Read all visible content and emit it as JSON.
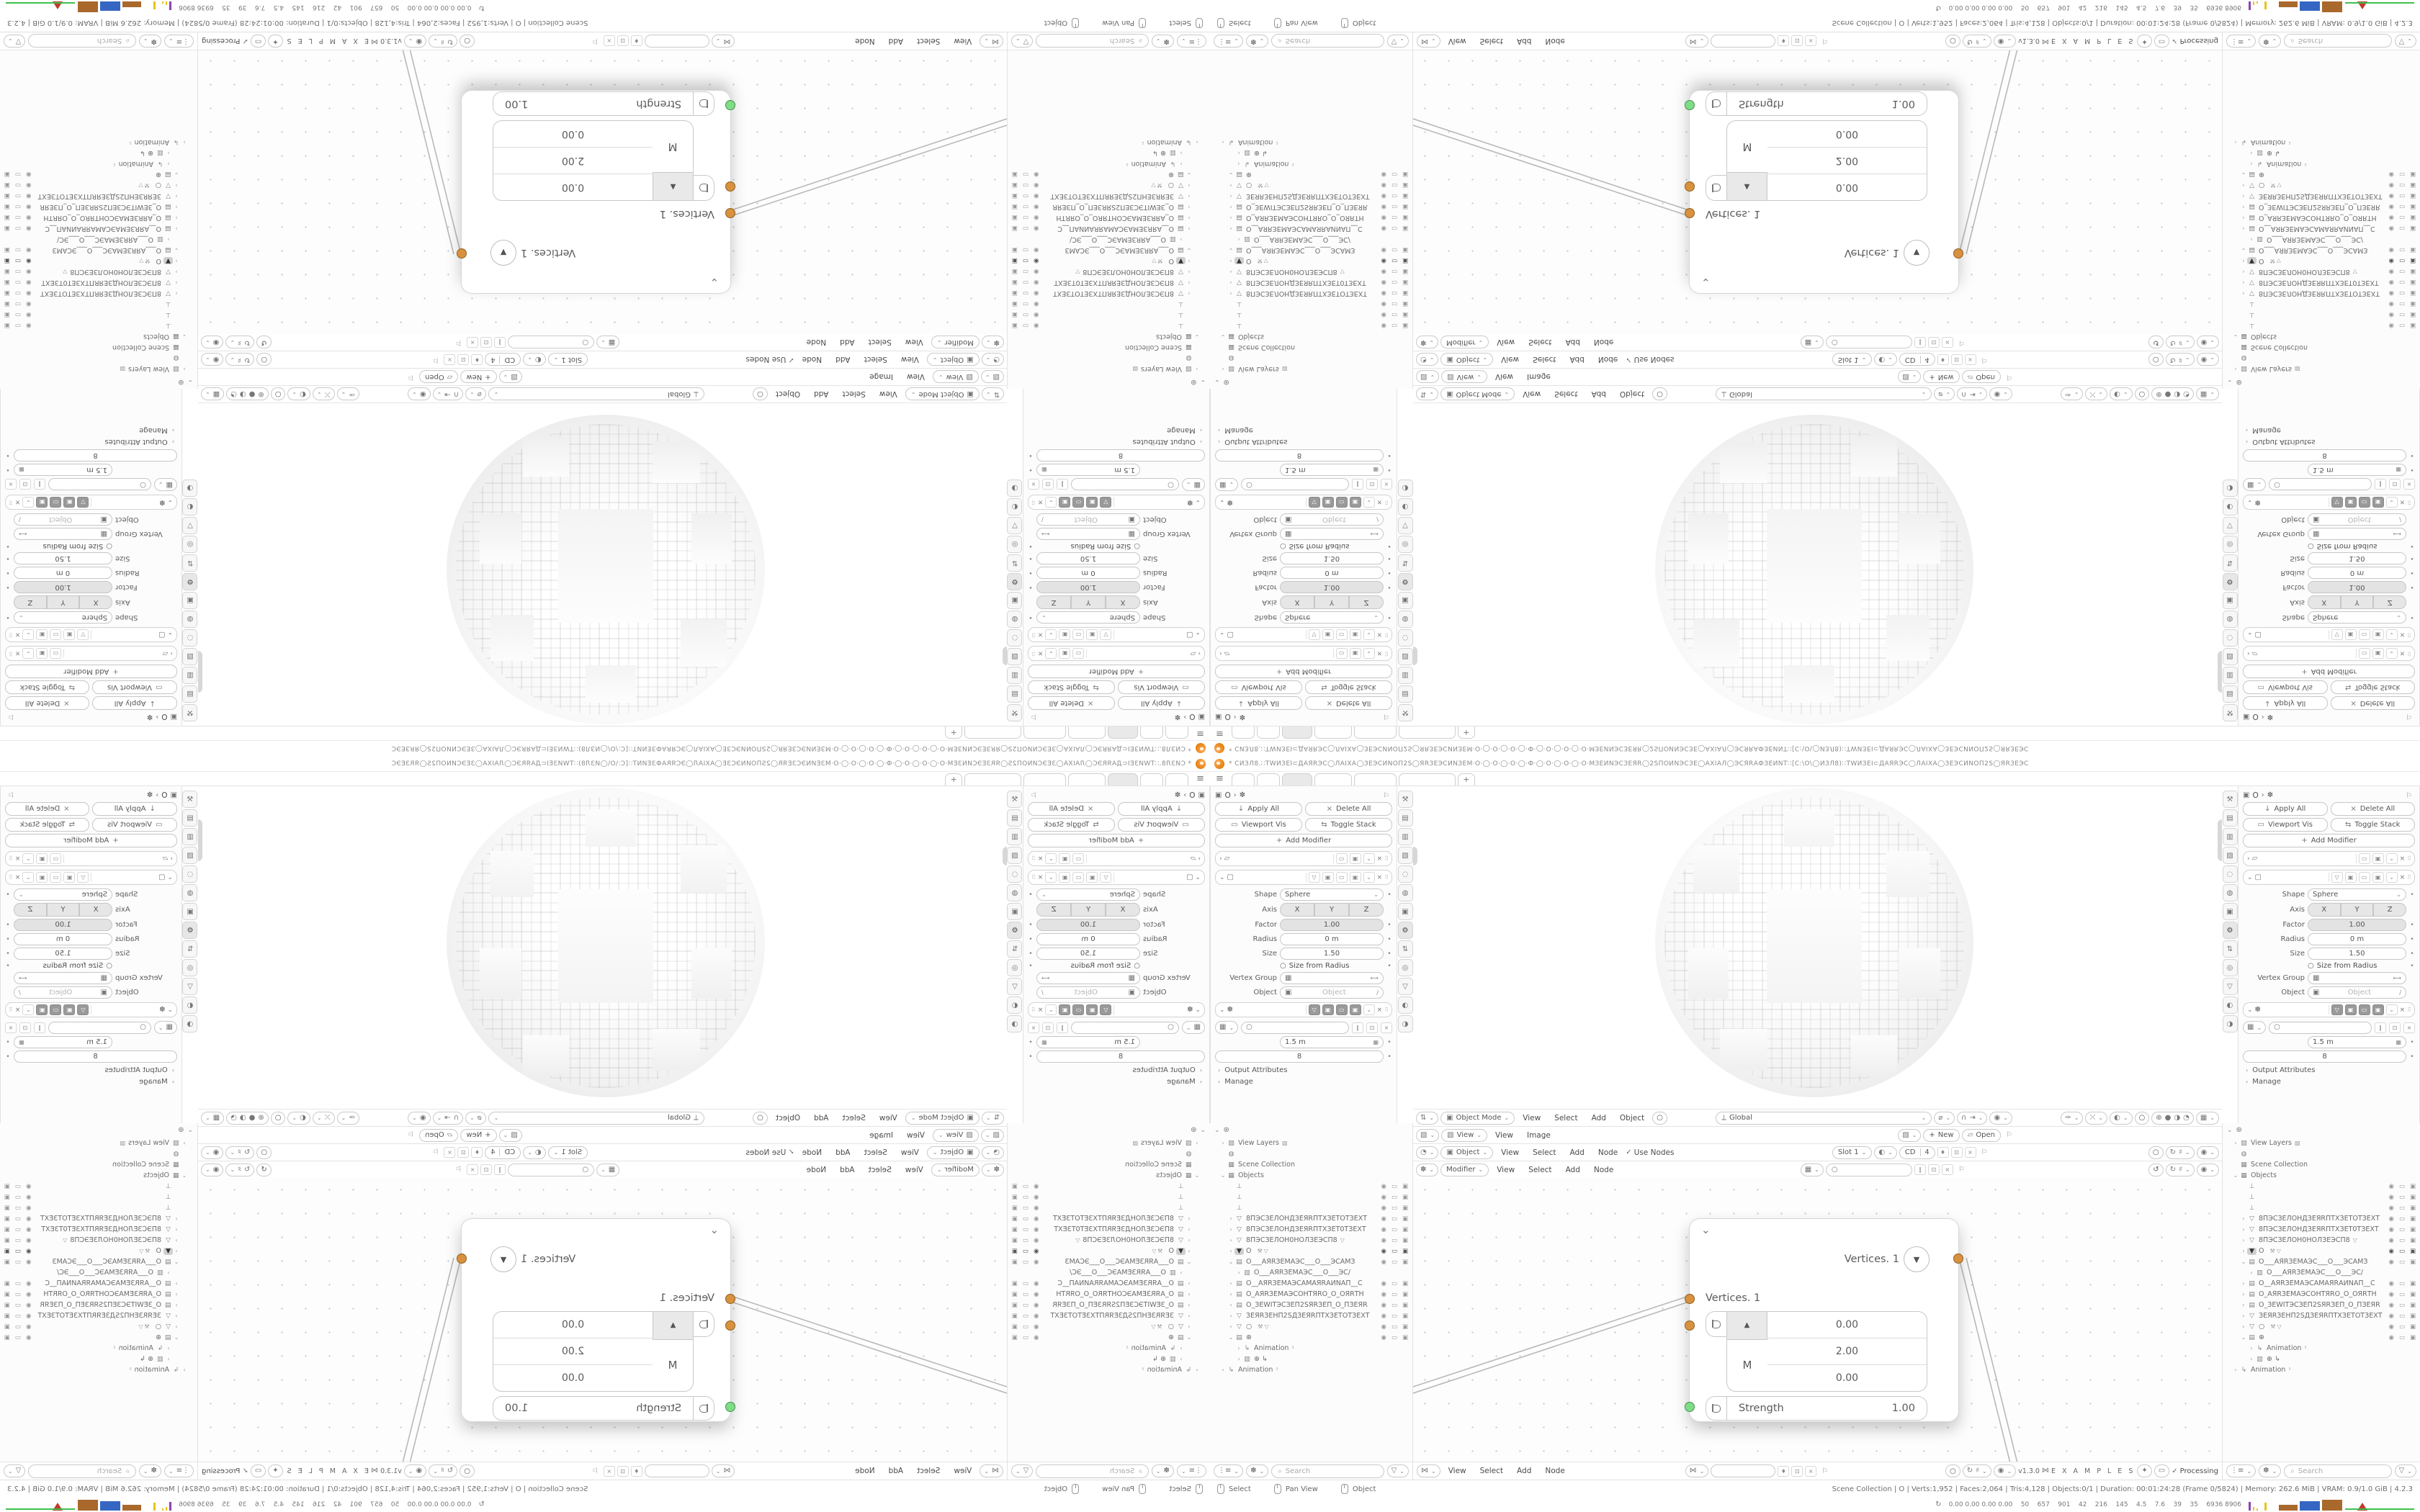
{
  "window": {
    "title": "* СИЗЛ8.∷ТWИЗЕІ⊂ДАЯRЭС◯ЛАІХА◯ЗЕЭСИNОП2S◯ЯRЗЕЭСИNЗЕМ·О·◯·О·◯·О·◯·Ф·◯·О·◯·О·◯·О·МЗЕИNЭСЗЕЯR◯2SПОИNЭСЗЕ◯АХІАЛ◯ЭСЯRАФЗЕИNТ∷[С:\\О\\◯ИЗЛ8)∷ТWИЗЕІ⊂ДАЯRЭС◯ЛАІХА◯ЗЕЭСИNОП2S◯ЯRЗЕЭС"
  },
  "icons": {
    "hamburger": "≡",
    "plus": "+",
    "chevron_down": "⌄",
    "chevron_right": "›",
    "tri_up": "▲",
    "tri_down": "▼",
    "close": "×",
    "check": "✓",
    "pin": "⚐",
    "circle": "○",
    "search": "⌕",
    "funnel": "▽",
    "grip": "⠿",
    "refresh": "↻",
    "filter": "⊛",
    "arrows": "⇅",
    "square": "▣",
    "image": "▧",
    "clock": "◔",
    "gear": "⚙",
    "nodes": "✽",
    "grid": "▦",
    "sphere_shade": "◐",
    "dna": "⋈",
    "shield": "♦",
    "copy": "⊡",
    "slash": "∥",
    "monitor": "▭",
    "camera_i": "▣",
    "down": "↓",
    "expand": "⇆",
    "wrench": "⚒",
    "walk": "✦",
    "globe": "⟂"
  },
  "tabs": {
    "count": 6,
    "active_index": 2,
    "add_label": "+"
  },
  "properties": {
    "tab_icons": [
      "⚒",
      "▤",
      "▥",
      "▧",
      "◌",
      "◍",
      "▣",
      "⚙",
      "⇅",
      "◎",
      "▽",
      "◐",
      "◑"
    ],
    "active_tab_index": 7,
    "breadcrumb": {
      "a": "▣",
      "b": "O",
      "sep": "›",
      "c": "✽"
    },
    "buttons": {
      "apply_all": "Apply All",
      "delete_all": "Delete All",
      "viewport_vis": "Viewport Vis",
      "toggle_stack": "Toggle Stack",
      "add_modifier": "Add Modifier"
    },
    "cast": {
      "shape_label": "Shape",
      "shape_value": "Sphere",
      "axis_label": "Axis",
      "axis_x": "X",
      "axis_y": "Y",
      "axis_z": "Z",
      "factor_label": "Factor",
      "factor_value": "1.00",
      "radius_label": "Radius",
      "radius_value": "0 m",
      "size_label": "Size",
      "size_value": "1.50",
      "size_from_radius": "Size from Radius",
      "vertex_group_label": "Vertex Group",
      "object_label": "Object",
      "object_placeholder": "Object"
    },
    "nodes_mod": {
      "value_m": "1.5 m",
      "value_count": "8",
      "output_attributes": "Output Attributes",
      "manage": "Manage"
    }
  },
  "outliner": {
    "search_placeholder": "Search",
    "rows": [
      {
        "d": 1,
        "e": ">",
        "i": "image",
        "label": "View Layers",
        "x": "▧"
      },
      {
        "d": 1,
        "e": "",
        "i": "world",
        "label": ""
      },
      {
        "d": 1,
        "e": "",
        "i": "collection",
        "label": "Scene Collection"
      },
      {
        "d": 1,
        "e": "v",
        "i": "collection",
        "label": "Objects"
      },
      {
        "d": 2,
        "e": "",
        "i": "empty",
        "label": "",
        "vis": true
      },
      {
        "d": 2,
        "e": "",
        "i": "empty",
        "label": "",
        "vis": true
      },
      {
        "d": 2,
        "e": "",
        "i": "empty",
        "label": "",
        "vis": true
      },
      {
        "d": 2,
        "e": ">",
        "i": "mesh",
        "label": "8ПЭСЗЕЛОНДЗЕЯRПТХЗЕТОТЗЕХТ",
        "vis": true
      },
      {
        "d": 2,
        "e": ">",
        "i": "mesh",
        "label": "8ПЭСЗЕЛОНДЗЕЯRПТХЗЕТ0ТЗЕХТ",
        "vis": true
      },
      {
        "d": 2,
        "e": ">",
        "i": "mesh",
        "label": "8ПЭСЗЕЛОН0НОЛЗЕЭСП8",
        "x": "▽",
        "vis": true
      },
      {
        "d": 2,
        "e": ">",
        "i": "mesh_sel",
        "label": "O",
        "tools": true,
        "vis": true,
        "sel": true
      },
      {
        "d": 2,
        "e": "v",
        "i": "camera",
        "label": "O___АЯRЗЕМАЭС___O___ЭСАМЗ",
        "vis": true
      },
      {
        "d": 3,
        "e": ">",
        "i": "camera_data",
        "label": "O___АЯRЗЕМАЭС___O___ЭС/"
      },
      {
        "d": 2,
        "e": ">",
        "i": "camera",
        "label": "O__АЯRЗЕМАЭСАМАЯRАИNАП__С",
        "vis": true
      },
      {
        "d": 2,
        "e": ">",
        "i": "camera",
        "label": "O_АЯRЗЕМАЭСОНТЯRО_O_ОЯRТН",
        "vis": true
      },
      {
        "d": 2,
        "e": ">",
        "i": "camera",
        "label": "O_ЗЕWІТЭСЗЕП2SЯRЗЕП_O_ПЗЕЯR",
        "vis": true
      },
      {
        "d": 2,
        "e": ">",
        "i": "mesh",
        "label": "ЗЕЯRЗЕНП2SДЗЕЯRПТХЗЕТОТЗЕХТ",
        "vis": true
      },
      {
        "d": 2,
        "e": ">",
        "i": "mesh",
        "label": "○",
        "tools": true,
        "vis": true
      },
      {
        "d": 2,
        "e": "v",
        "i": "camera",
        "label": "⊕",
        "vis": true
      },
      {
        "d": 3,
        "e": ">",
        "i": "anim",
        "label": "Animation",
        "badge": "²"
      },
      {
        "d": 3,
        "e": ">",
        "i": "camera_data",
        "label": "⊕  ↳"
      },
      {
        "d": 1,
        "e": ">",
        "i": "anim",
        "label": "Animation",
        "badge": "²"
      }
    ],
    "icon_map": {
      "mesh": "▽",
      "mesh_sel": "▼",
      "camera": "▤",
      "camera_data": "▥",
      "empty": "⊥",
      "anim": "↳",
      "world": "◍",
      "collection": "▦",
      "image": "▧"
    },
    "vis_icons": {
      "eye": "◉",
      "screen": "▭",
      "camera": "▣"
    }
  },
  "headers": {
    "viewport": {
      "mode": "Object Mode",
      "m1": "View",
      "m2": "Select",
      "m3": "Add",
      "m4": "Object",
      "orientation": "Global"
    },
    "image": {
      "dropdown": "View",
      "m1": "View",
      "m2": "Image",
      "new_label": "New",
      "open_label": "Open"
    },
    "shader": {
      "dropdown": "Object",
      "m1": "View",
      "m2": "Select",
      "m3": "Add",
      "m4": "Node",
      "use_nodes": "Use Nodes",
      "slot": "Slot 1",
      "datablock": "CD",
      "users": "4"
    },
    "geonodes": {
      "dropdown": "Modifier",
      "m1": "View",
      "m2": "Select",
      "m3": "Add",
      "m4": "Node"
    },
    "bottom_node": {
      "m1": "View",
      "m2": "Select",
      "m3": "Add",
      "m4": "Node"
    }
  },
  "node": {
    "output_label": "Vertices. 1",
    "input_label": "Vertices. 1",
    "vector_axis_label": "M",
    "vector_values": [
      "0.00",
      "2.00",
      "0.00"
    ],
    "strength_label": "Strength",
    "strength_value": "1.00"
  },
  "footer": {
    "version": "v1.3.0",
    "examples": "E X A M P L E S",
    "processing": "Processing",
    "search_placeholder": "Search"
  },
  "statusbar": {
    "hints": [
      "Select",
      "Pan View",
      "Object"
    ],
    "stats": "Scene Collection | O | Verts:1,952 | Faces:2,064 | Tris:4,128 | Objects:0/1  |  Duration: 00:01:24:28 (Frame 0/5824) | Memory: 262.6 MiB | VRAM: 0.9/1.0 GiB | 4.2.3"
  },
  "profiler": {
    "values": "0.00 0.00 0.00 0.00    50    657    901    42    216    145    4.5    7.6    39    35    6936 8906"
  },
  "colors": {
    "accent_orange": "#e87d0d",
    "socket_orange": "#d8913f",
    "socket_green": "#7fdc87",
    "histo_purple": "#8e44ad",
    "histo_yellow": "#e8c41e",
    "histo_brown": "#a9692c",
    "histo_blue": "#3566c4",
    "histo_red": "#c0392b",
    "histo_green": "#3fc04f"
  }
}
